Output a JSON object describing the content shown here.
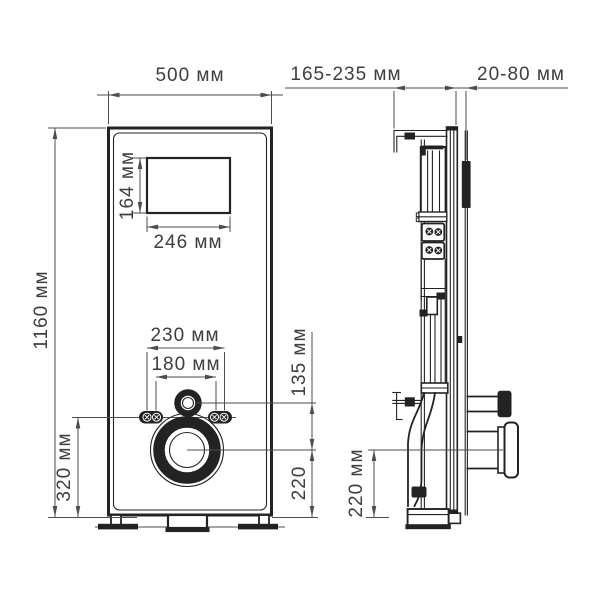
{
  "colors": {
    "line": "#232323",
    "dim": "#4d4d4d",
    "text": "#3e3e3e",
    "bg": "#ffffff"
  },
  "front_view": {
    "width_label": "500 мм",
    "height_label": "1160 мм",
    "window_width_label": "246 мм",
    "window_height_label": "164 мм",
    "stud_spacing_outer_label": "230 мм",
    "stud_spacing_inner_label": "180 мм",
    "stud_height_label": "320 мм",
    "inlet_to_outlet_label": "135 мм",
    "outlet_height_label": "220"
  },
  "side_view": {
    "depth_range_label": "165-235 мм",
    "wall_gap_range_label": "20-80 мм",
    "outlet_height_label": "220 мм"
  }
}
